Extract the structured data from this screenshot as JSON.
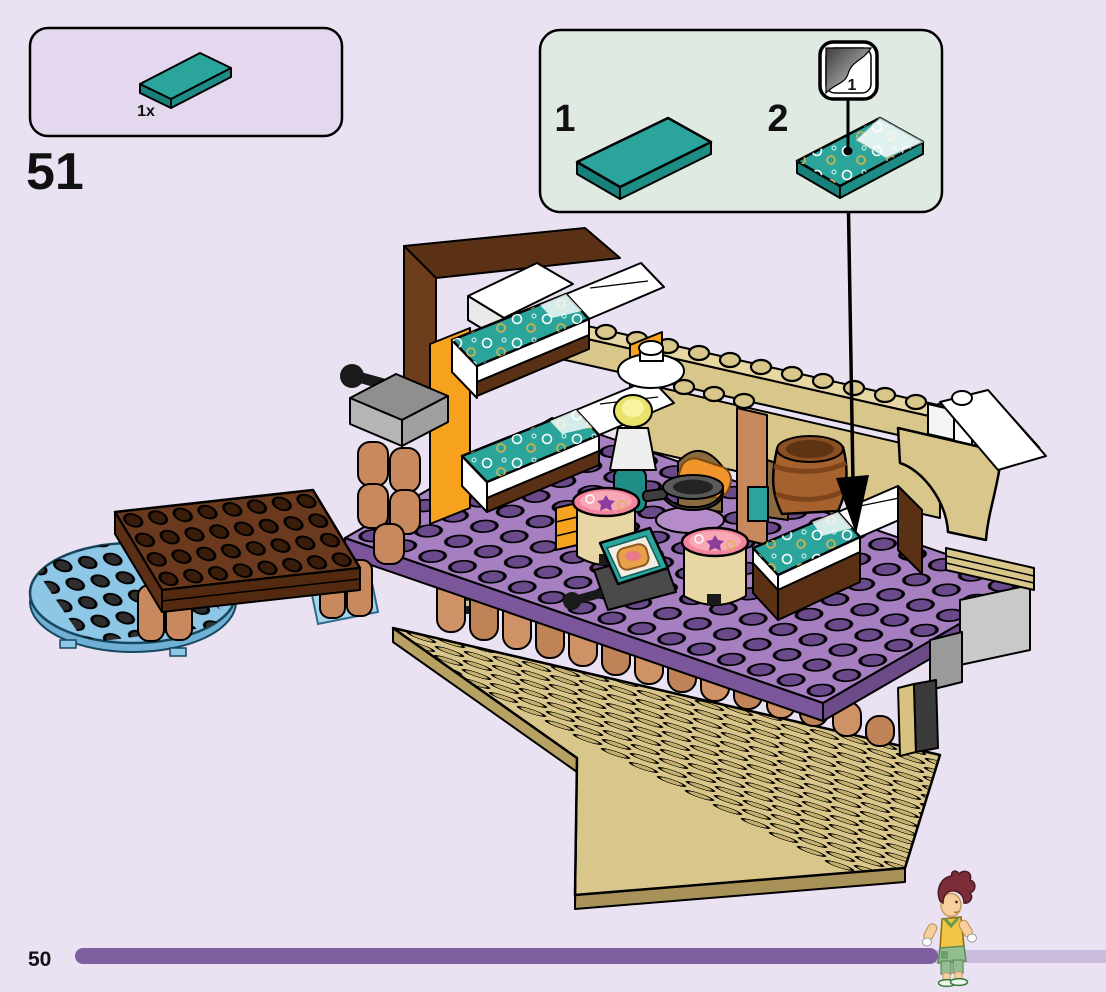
{
  "page": {
    "number": "50",
    "background_color": "#eae2f2"
  },
  "step": {
    "number": "51"
  },
  "parts_callout": {
    "quantity": "1x",
    "part": "teal-2x4-tile"
  },
  "substep_panel": {
    "step1_label": "1",
    "step2_label": "2",
    "sticker_sheet_number": "1"
  },
  "progress_bar": {
    "filled_color": "#7e5fa0",
    "track_color": "#cbbcdf"
  },
  "palette": {
    "callout_bg": "#e4d8ee",
    "substep_bg": "#dfeae2",
    "teal_tile": "#2ba49c",
    "teal_tile_side": "#1d8d86",
    "deck_purple": "#a57fc0",
    "deck_purple_stud": "#6b4a8c",
    "deck_tan": "#d8c68b",
    "deck_tan_stud": "#c3ae6c",
    "dock_brown": "#6b3a1e",
    "log_nougat": "#cf9267",
    "water_blue": "#8ec6e6",
    "bed_frame_brown": "#5a3115",
    "wall_orange": "#f6a21e",
    "barrel_brown": "#a5612e",
    "lid_pink": "#f2849b"
  },
  "figure": {
    "hair": "#7b2e38",
    "top": "#f4c445",
    "shorts": "#93bd8e",
    "skin": "#f7cf9e"
  }
}
